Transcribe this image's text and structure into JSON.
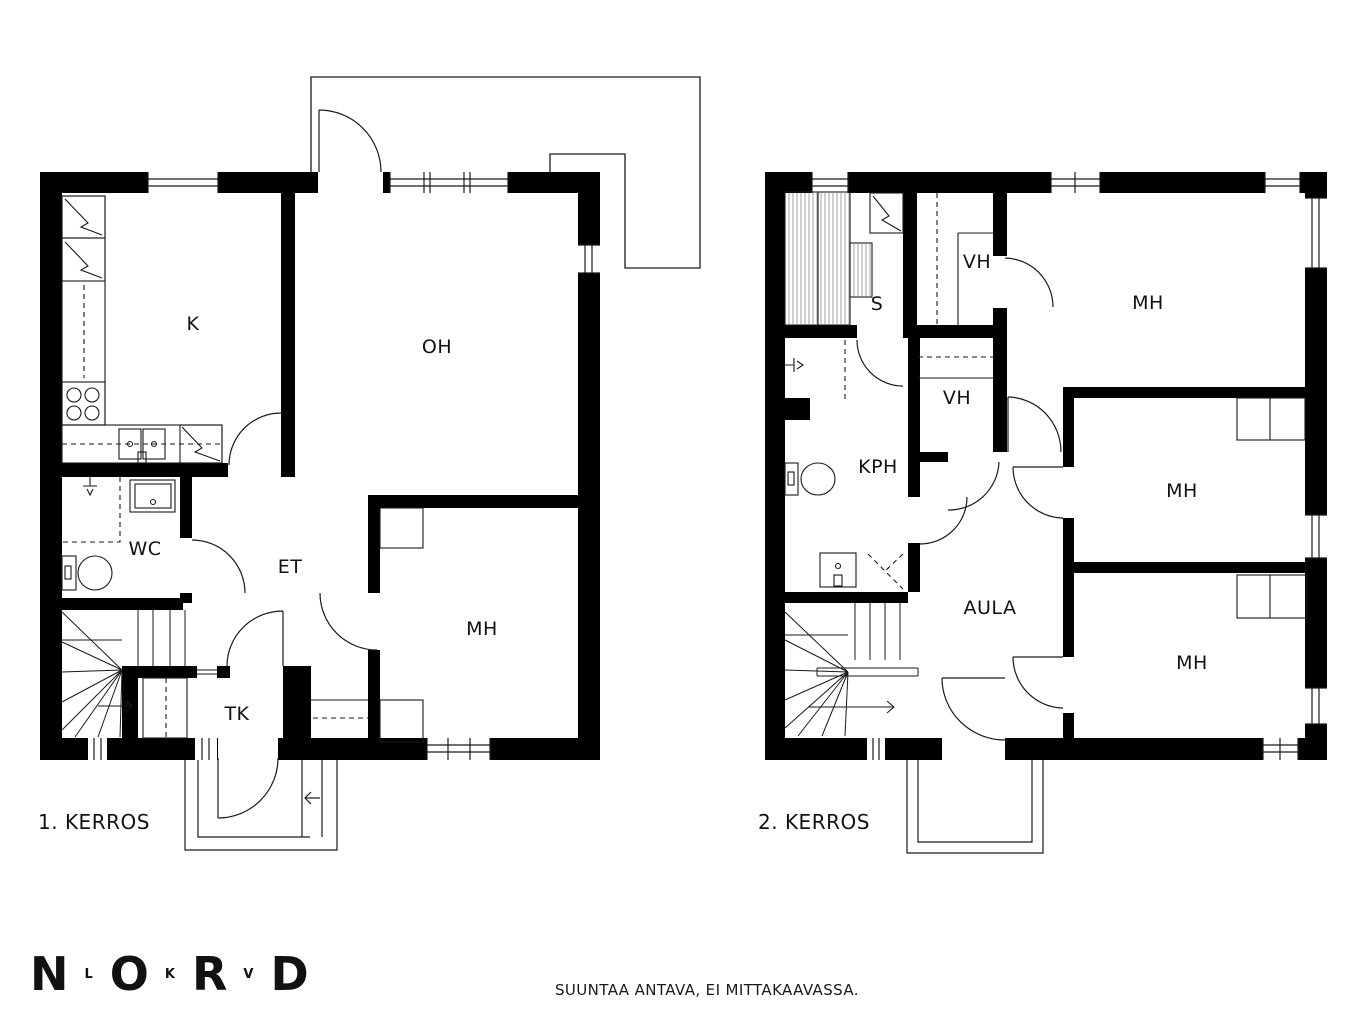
{
  "floor1": {
    "label": "1. KERROS",
    "rooms": {
      "k": "K",
      "oh": "OH",
      "wc": "WC",
      "et": "ET",
      "mh": "MH",
      "tk": "TK"
    }
  },
  "floor2": {
    "label": "2. KERROS",
    "rooms": {
      "s": "S",
      "vh_top": "VH",
      "vh_mid": "VH",
      "kph": "KPH",
      "aula": "AULA",
      "mh_top": "MH",
      "mh_mid": "MH",
      "mh_bottom": "MH"
    }
  },
  "footer": {
    "logo": {
      "letters": [
        {
          "char": "N",
          "size": "large"
        },
        {
          "char": "L",
          "size": "small"
        },
        {
          "char": "O",
          "size": "large"
        },
        {
          "char": "K",
          "size": "small"
        },
        {
          "char": "R",
          "size": "large"
        },
        {
          "char": "V",
          "size": "small"
        },
        {
          "char": "D",
          "size": "large"
        }
      ]
    },
    "disclaimer": "SUUNTAA ANTAVA, EI MITTAKAAVASSA."
  },
  "colors": {
    "wall": "#000000",
    "line": "#1a1a1a",
    "hatch": "#999999",
    "background": "#ffffff"
  }
}
